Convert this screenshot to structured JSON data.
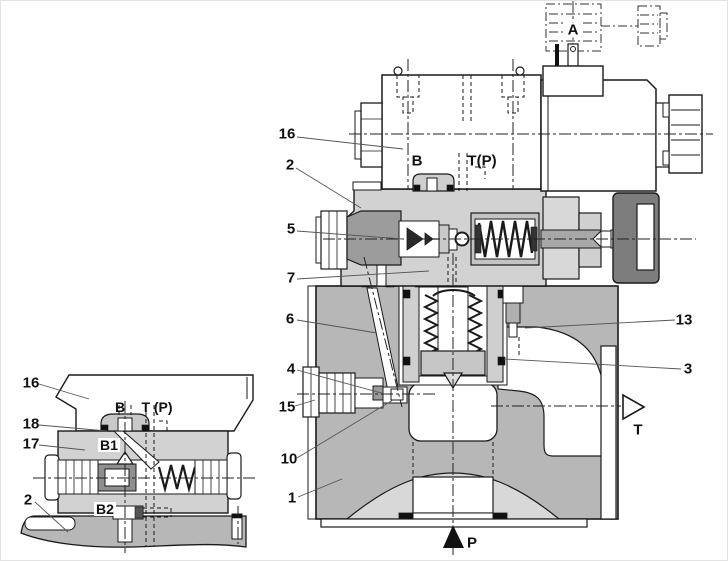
{
  "main_view": {
    "callouts": [
      {
        "label": "16"
      },
      {
        "label": "2"
      },
      {
        "label": "5"
      },
      {
        "label": "7"
      },
      {
        "label": "6"
      },
      {
        "label": "4"
      },
      {
        "label": "15"
      },
      {
        "label": "10"
      },
      {
        "label": "1"
      },
      {
        "label": "13"
      },
      {
        "label": "3"
      }
    ],
    "ports": [
      {
        "label": "A"
      },
      {
        "label": "B"
      },
      {
        "label": "T(P)"
      },
      {
        "label": "T"
      },
      {
        "label": "P"
      }
    ]
  },
  "detail_view": {
    "callouts": [
      {
        "label": "16"
      },
      {
        "label": "18"
      },
      {
        "label": "17"
      },
      {
        "label": "2"
      }
    ],
    "ports": [
      {
        "label": "B"
      },
      {
        "label": "T (P)"
      },
      {
        "label": "B1"
      },
      {
        "label": "B2"
      }
    ]
  },
  "colors": {
    "outline": "#1a1a1a",
    "body_gray": "#b7b7b7",
    "plate_gray": "#d2d2d2",
    "part_gray": "#9c9c9c",
    "knob_gray": "#7d7d7d",
    "chamfer_gray": "#d8d8d8",
    "background": "#ffffff"
  }
}
